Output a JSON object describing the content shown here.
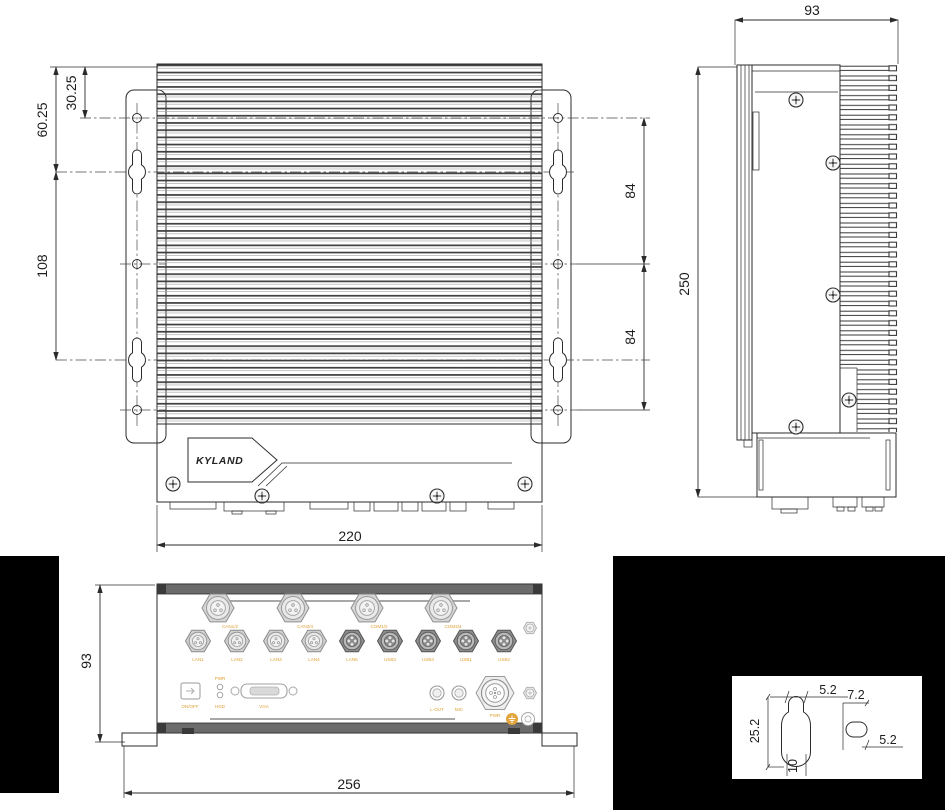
{
  "front_view": {
    "dim_30_25": "30.25",
    "dim_60_25": "60.25",
    "dim_108": "108",
    "dim_84_top": "84",
    "dim_84_bottom": "84",
    "dim_220": "220",
    "logo": "KYLAND"
  },
  "side_view": {
    "dim_93": "93",
    "dim_250": "250"
  },
  "bottom_view": {
    "dim_93": "93",
    "dim_256": "256",
    "top_ports": [
      "CAN1/2",
      "CAN3/4",
      "COM1/2",
      "COM3/4"
    ],
    "mid_ports": [
      "LAN1",
      "LAN2",
      "LAN3",
      "LAN4",
      "LAN5",
      "USB3",
      "USB4",
      "USB1",
      "USB2"
    ],
    "io": {
      "power_button": "ON/OFF",
      "led_top": "PWR",
      "led_bottom": "HDD",
      "vga": "VGA",
      "line_out": "L-OUT",
      "mic": "MIC",
      "power": "PWR"
    }
  },
  "detail_view": {
    "dim_slot_width_top": "5.2",
    "dim_slot_length": "25.2",
    "dim_slot_bulge": "10",
    "dim_hole_length": "7.2",
    "dim_hole_width": "5.2"
  },
  "colors": {
    "line": "#2b2b2b",
    "label_orange": "#dfa035",
    "dark_bar": "#6b6b6b",
    "background": "#ffffff",
    "mask_black": "#000000"
  }
}
